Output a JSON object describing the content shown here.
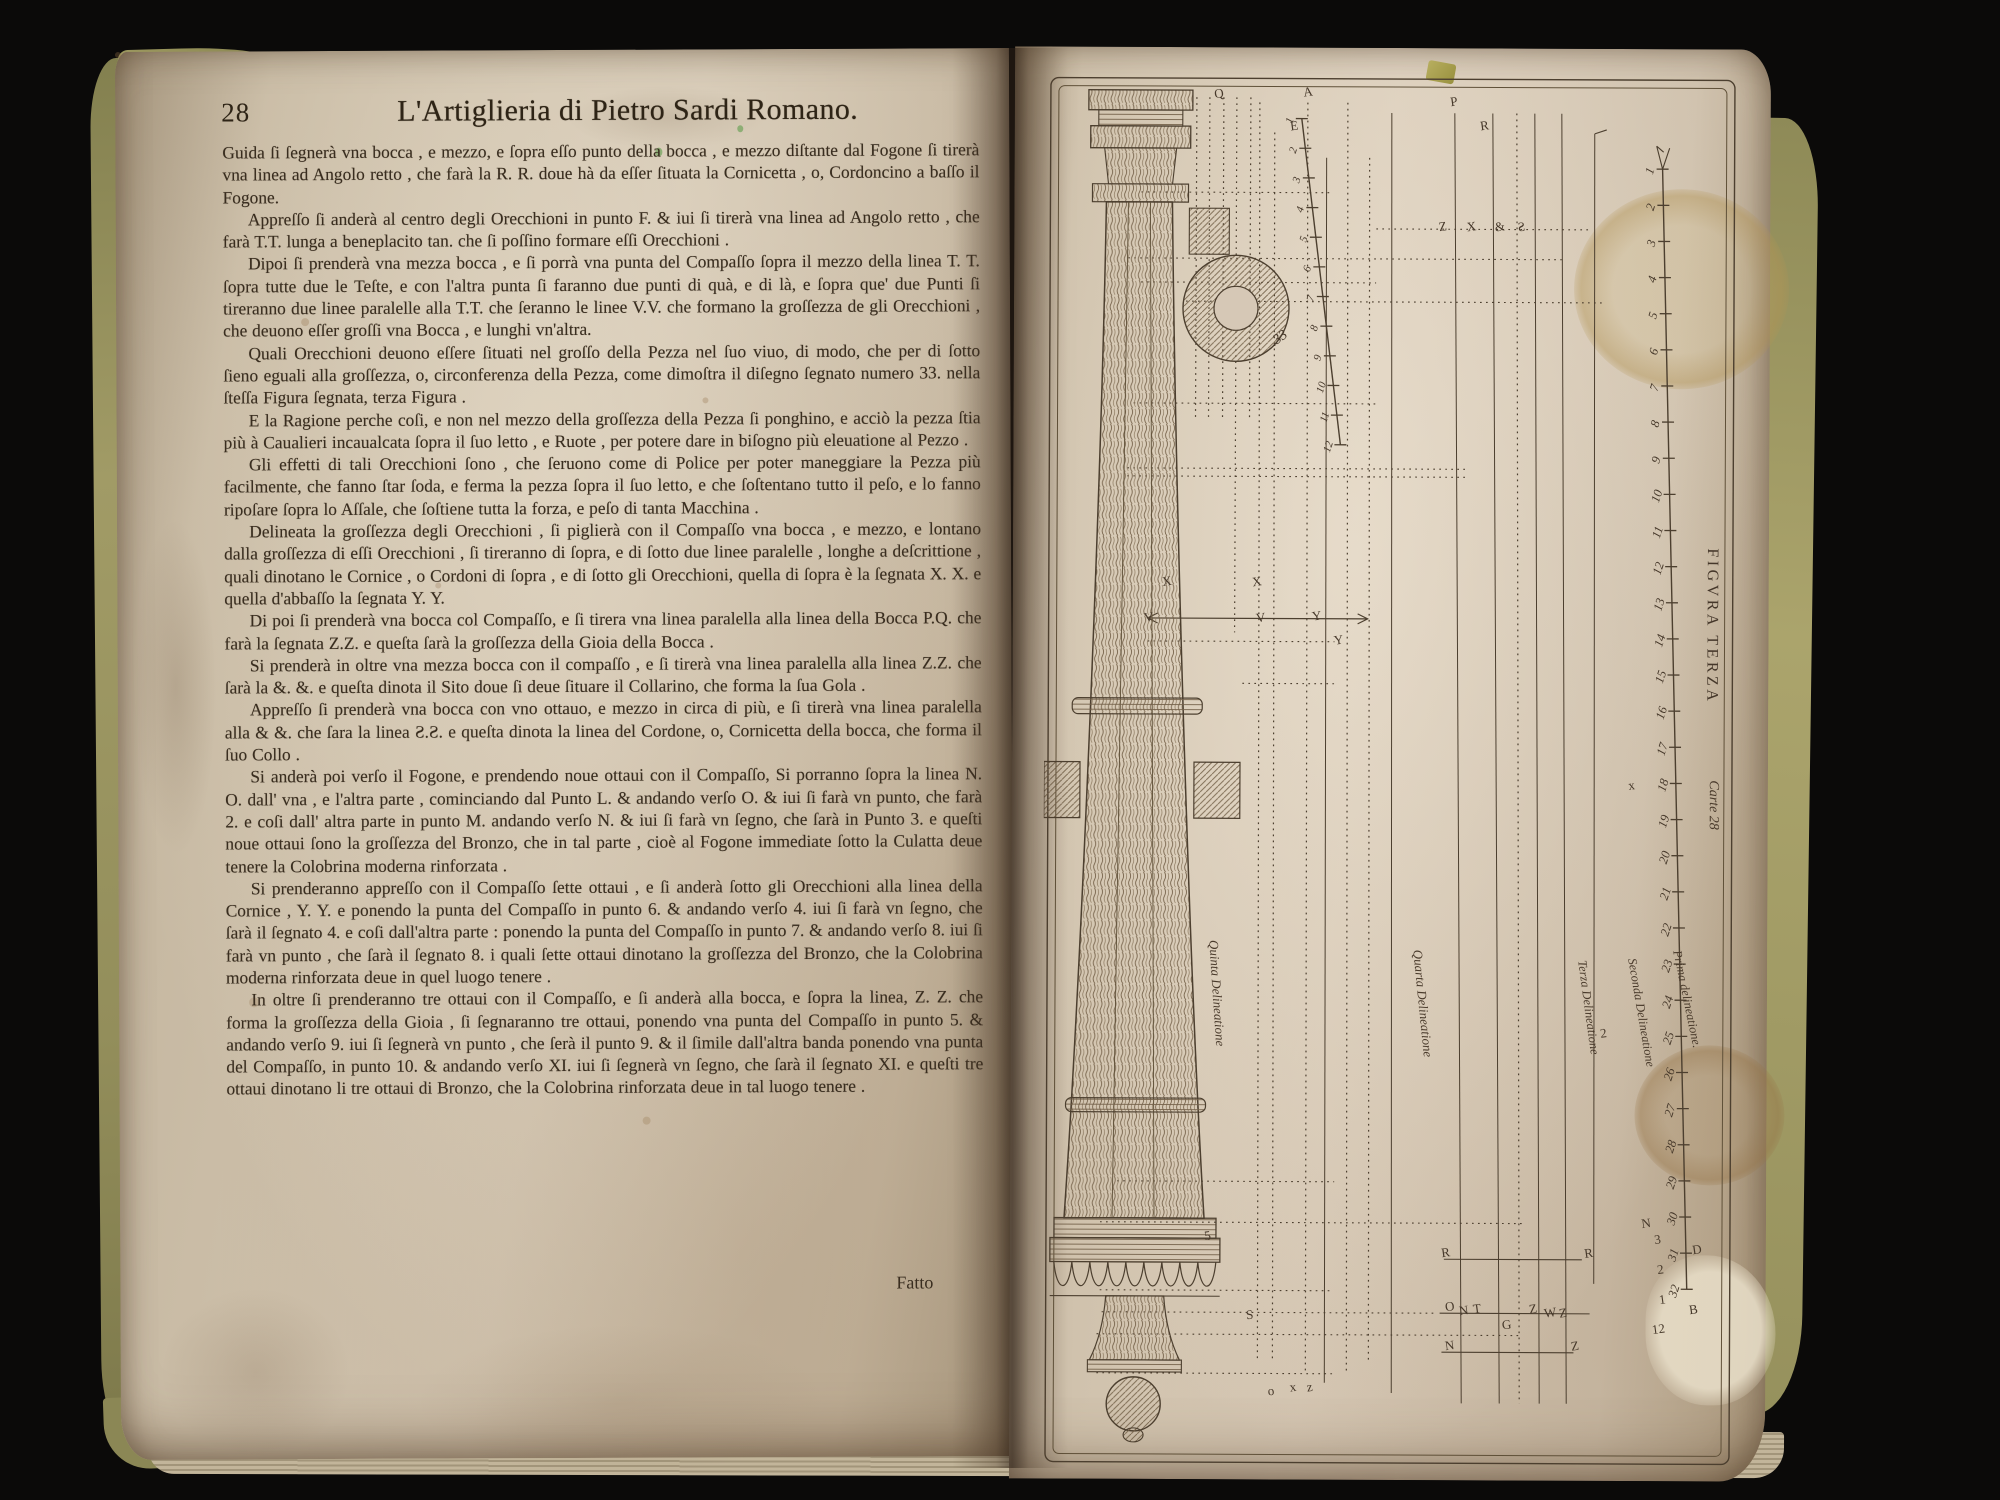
{
  "book": {
    "left_page": {
      "page_number": "28",
      "title": "L'Artiglieria di Pietro Sardi Romano.",
      "paragraphs": [
        "Guida ſi ſegnerà vna bocca , e mezzo, e ſopra eſſo punto della bocca , e mezzo diſtante dal Fogone ſi tirerà vna linea ad Angolo retto , che farà la R. R. doue hà da eſſer ſituata la Cornicetta , o, Cordoncino a baſſo il Fogone.",
        "Appreſſo ſi anderà al centro degli Orecchioni in punto F. & iui ſi tirerà vna linea ad Angolo retto , che farà T.T. lunga a beneplacito tan. che ſi poſſino formare eſſi Orecchioni .",
        "Dipoi ſi prenderà vna mezza bocca , e ſi porrà vna punta del Compaſſo ſopra il mezzo della linea T. T. ſopra tutte due le Teſte, e con l'altra punta ſi faranno due punti di quà, e di là, e ſopra que' due Punti ſi tireranno due linee paralelle alla T.T. che ſeranno le linee V.V. che formano la groſſezza de gli Orecchioni , che deuono eſſer groſſi vna Bocca , e lunghi vn'altra.",
        "Quali Orecchioni deuono eſſere ſituati nel groſſo della Pezza nel ſuo viuo, di modo, che per di ſotto ſieno eguali alla groſſezza, o, circonferenza della Pezza, come dimoſtra il diſegno ſegnato numero 33. nella ſteſſa Figura ſegnata, terza Figura .",
        "E la Ragione perche coſi, e non nel mezzo della groſſezza della Pezza ſi ponghino, e acciò la pezza ſtia più à Caualieri incaualcata ſopra il ſuo letto , e Ruote , per potere dare in biſogno più eleuatione al Pezzo .",
        "Gli effetti di tali Orecchioni ſono , che ſeruono come di Police per poter maneggiare la Pezza più facilmente, che fanno ſtar ſoda, e ferma la pezza ſopra il ſuo letto, e che ſoſtentano tutto il peſo, e lo fanno ripoſare ſopra lo Aſſale, che ſoſtiene tutta la forza, e peſo di tanta Macchina .",
        "Delineata la groſſezza degli Orecchioni , ſi piglierà con il Compaſſo vna bocca , e mezzo, e lontano dalla groſſezza di eſſi Orecchioni , ſi tireranno di ſopra, e di ſotto due linee paralelle , longhe a deſcrittione , quali dinotano le Cornice , o Cordoni di ſopra , e di ſotto gli Orecchioni, quella di ſopra è la ſegnata X. X. e quella d'abbaſſo la ſegnata Y. Y.",
        "Di poi ſi prenderà vna bocca col Compaſſo, e ſi tirera vna linea paralella alla linea della Bocca P.Q. che farà la ſegnata Z.Z. e queſta ſarà la groſſezza della Gioia della Bocca .",
        "Si prenderà in oltre vna mezza bocca con il compaſſo , e ſi tirerà vna linea paralella alla linea Z.Z. che ſarà la &. &. e queſta dinota il Sito doue ſi deue ſituare il Collarino, che forma la ſua Gola .",
        "Appreſſo ſi prenderà vna bocca con vno ottauo, e mezzo in circa di più, e ſi tirerà vna linea paralella alla & &. che ſara la linea Ƨ.Ƨ. e queſta dinota la linea del Cordone, o, Cornicetta della bocca, che forma il ſuo Collo .",
        "Si anderà poi verſo il Fogone, e prendendo noue ottaui con il Compaſſo, Si porranno ſopra la linea N. O. dall' vna , e l'altra parte , cominciando dal Punto L. & andando verſo O. & iui ſi farà vn punto, che farà 2. e coſi dall' altra parte in punto M. andando verſo N. & iui ſi farà vn ſegno, che ſarà in Punto 3. e queſti noue ottaui ſono la groſſezza del Bronzo, che in tal parte , cioè al Fogone immediate ſotto la Culatta deue tenere la Colobrina moderna rinforzata .",
        "Si prenderanno appreſſo con il Compaſſo ſette ottaui , e ſi anderà ſotto gli Orecchioni alla linea della Cornice , Y. Y. e ponendo la punta del Compaſſo in punto 6. & andando verſo 4. iui ſi farà vn ſegno, che ſarà il ſegnato 4. e coſi dall'altra parte : ponendo la punta del Compaſſo in punto 7. & andando verſo 8. iui ſi farà vn punto , che ſarà il ſegnato 8. i quali ſette ottaui dinotano la groſſezza del Bronzo, che la Colobrina moderna rinforzata deue in quel luogo tenere .",
        "In oltre ſi prenderanno tre ottaui con il Compaſſo, e ſi anderà alla bocca, e ſopra la linea, Z. Z. che forma la groſſezza della Gioia , ſi ſegnaranno tre ottaui, ponendo vna punta del Compaſſo in punto 5. & andando verſo 9. iui ſi ſegnerà vn punto , che ſerà il punto 9. & il ſimile dall'altra banda ponendo vna punta del Compaſſo, in punto 10. & andando verſo XI. iui ſi ſegnerà vn ſegno, che ſarà il ſegnato XI. e queſti tre ottaui dinotano li tre ottaui di Bronzo, che la Colobrina rinforzata deue in tal luogo tenere ."
      ],
      "closing": "Fatto"
    },
    "right_page": {
      "plate": {
        "figure_label_vertical": "FIGVRA TERZA",
        "carte_label": "Carte 28",
        "section_number": "33",
        "delineation_labels": [
          "Quinta Delineatione",
          "Quarta Delineatione",
          "Terza Delineatione",
          "Seconda Delineatione",
          "Prima delineatione."
        ],
        "main_scale_numbers": [
          1,
          2,
          3,
          4,
          5,
          6,
          7,
          8,
          9,
          10,
          11,
          12,
          13,
          14,
          15,
          16,
          17,
          18,
          19,
          20,
          21,
          22,
          23,
          24,
          25,
          26,
          27,
          28,
          29,
          30,
          31,
          32
        ],
        "secondary_scale_numbers": [
          1,
          2,
          3,
          4,
          5,
          6,
          7,
          8,
          9,
          10,
          11,
          12
        ],
        "point_letters": [
          {
            "ch": "A",
            "x": 257,
            "y": 24
          },
          {
            "ch": "E",
            "x": 244,
            "y": 58
          },
          {
            "ch": "Q",
            "x": 168,
            "y": 26
          },
          {
            "ch": "P",
            "x": 404,
            "y": 33
          },
          {
            "ch": "R",
            "x": 434,
            "y": 57
          },
          {
            "ch": "Z",
            "x": 393,
            "y": 158
          },
          {
            "ch": "X",
            "x": 421,
            "y": 158
          },
          {
            "ch": "&",
            "x": 449,
            "y": 158
          },
          {
            "ch": "Ƨ",
            "x": 472,
            "y": 158
          },
          {
            "ch": "X",
            "x": 118,
            "y": 514
          },
          {
            "ch": "X",
            "x": 208,
            "y": 514
          },
          {
            "ch": "V",
            "x": 100,
            "y": 550
          },
          {
            "ch": "V",
            "x": 212,
            "y": 550
          },
          {
            "ch": "Y",
            "x": 268,
            "y": 548
          },
          {
            "ch": "Y",
            "x": 290,
            "y": 572
          },
          {
            "ch": "x",
            "x": 585,
            "y": 716
          },
          {
            "ch": "2",
            "x": 558,
            "y": 964
          },
          {
            "ch": "5",
            "x": 163,
            "y": 1168
          },
          {
            "ch": "S",
            "x": 205,
            "y": 1247
          },
          {
            "ch": "o",
            "x": 227,
            "y": 1323
          },
          {
            "ch": "x",
            "x": 249,
            "y": 1319
          },
          {
            "ch": "z",
            "x": 266,
            "y": 1319
          },
          {
            "ch": "R",
            "x": 400,
            "y": 1184
          },
          {
            "ch": "R",
            "x": 543,
            "y": 1184
          },
          {
            "ch": "O",
            "x": 404,
            "y": 1238
          },
          {
            "ch": "N",
            "x": 418,
            "y": 1242
          },
          {
            "ch": "T",
            "x": 432,
            "y": 1240
          },
          {
            "ch": "G",
            "x": 461,
            "y": 1256
          },
          {
            "ch": "Z",
            "x": 488,
            "y": 1240
          },
          {
            "ch": "W",
            "x": 503,
            "y": 1244
          },
          {
            "ch": "Z",
            "x": 518,
            "y": 1244
          },
          {
            "ch": "N",
            "x": 404,
            "y": 1277
          },
          {
            "ch": "Z",
            "x": 530,
            "y": 1277
          },
          {
            "ch": "N",
            "x": 600,
            "y": 1154
          },
          {
            "ch": "3",
            "x": 613,
            "y": 1170
          },
          {
            "ch": "2",
            "x": 616,
            "y": 1200
          },
          {
            "ch": "1",
            "x": 618,
            "y": 1230
          },
          {
            "ch": "12",
            "x": 611,
            "y": 1260
          },
          {
            "ch": "D",
            "x": 651,
            "y": 1180
          },
          {
            "ch": "B",
            "x": 648,
            "y": 1240
          }
        ]
      }
    }
  }
}
